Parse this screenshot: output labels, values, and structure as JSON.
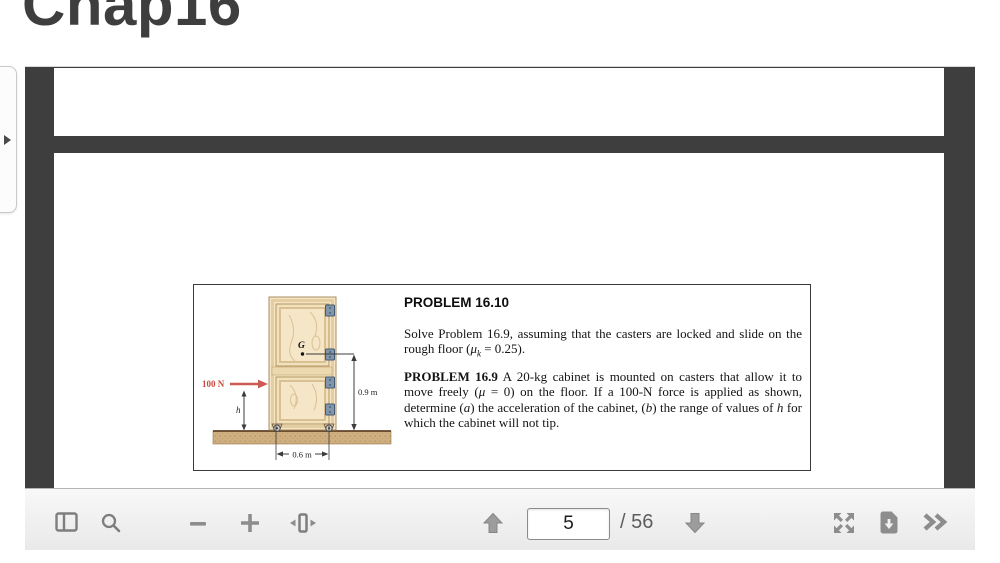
{
  "page": {
    "title": "Chap16"
  },
  "sidebar_tab": {
    "icon": "chevron-right"
  },
  "viewer": {
    "background_color": "#3e3e3e",
    "toolbar": {
      "page_input": {
        "value": "5"
      },
      "page_count_label": "/ 56",
      "buttons": [
        "toggle-sidebar",
        "search",
        "zoom-out",
        "zoom-in",
        "fit-width",
        "previous-page",
        "next-page",
        "fullscreen",
        "download",
        "more-tools"
      ]
    }
  },
  "pdf": {
    "problem": {
      "heading": "PROBLEM 16.10",
      "para1_segments": [
        {
          "t": "Solve Problem 16.9, assuming that the casters are locked and slide on the rough floor ("
        },
        {
          "t": "μ",
          "i": true
        },
        {
          "t": "k",
          "i": true,
          "sub": true
        },
        {
          "t": " = 0.25)."
        }
      ],
      "para2_segments": [
        {
          "t": "PROBLEM 16.9",
          "b": true
        },
        {
          "t": " A 20-kg cabinet is mounted on casters that allow it to move freely ("
        },
        {
          "t": "μ",
          "i": true
        },
        {
          "t": " = 0)  on the floor. If a 100-N force is applied as shown, determine ("
        },
        {
          "t": "a",
          "i": true
        },
        {
          "t": ") the acceleration of the cabinet, ("
        },
        {
          "t": "b",
          "i": true
        },
        {
          "t": ") the range of values of "
        },
        {
          "t": "h",
          "i": true
        },
        {
          "t": " for which the cabinet will not tip."
        }
      ]
    },
    "figure": {
      "force_label": "100 N",
      "g_label": "G",
      "h_label": "h",
      "height_dim": "0.9 m",
      "width_dim": "0.6 m",
      "accent_red": "#c84a42",
      "wood_color": "#f4e6c6",
      "floor_color": "#cfae80"
    }
  }
}
